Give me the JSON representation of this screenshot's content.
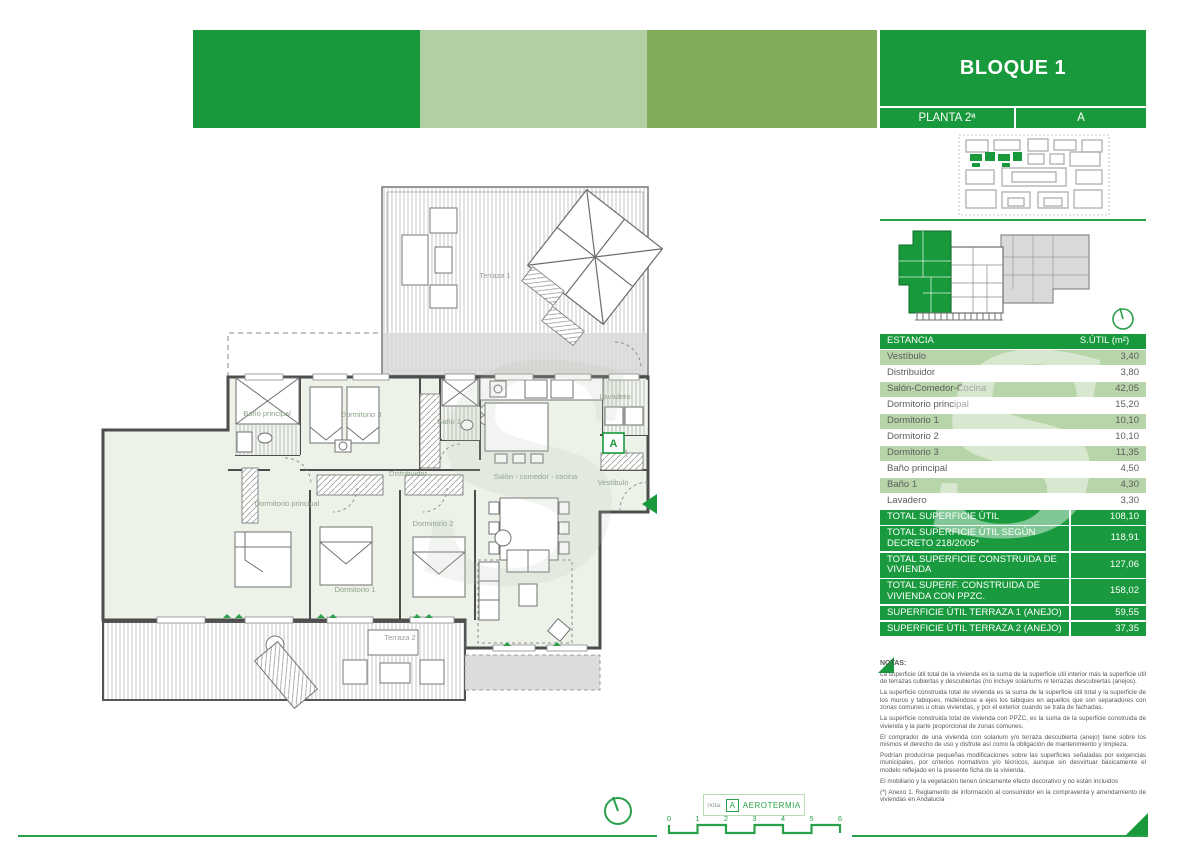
{
  "colors": {
    "brand_green": "#18993b",
    "light_green_block": "#b2cfa4",
    "olive_green_block": "#82ac5b",
    "table_row_green": "#b8d5a9"
  },
  "panel": {
    "title": "BLOQUE 1",
    "floor": "PLANTA 2ª",
    "unit": "A",
    "table": {
      "headers": [
        "ESTANCIA",
        "S.ÚTIL (m²)"
      ],
      "rows": [
        {
          "label": "Vestíbulo",
          "value": "3,40"
        },
        {
          "label": "Distribuidor",
          "value": "3,80"
        },
        {
          "label": "Salón-Comedor-Cocina",
          "value": "42,05"
        },
        {
          "label": "Dormitorio principal",
          "value": "15,20"
        },
        {
          "label": "Dormitorio 1",
          "value": "10,10"
        },
        {
          "label": "Dormitorio 2",
          "value": "10,10"
        },
        {
          "label": "Dormitorio 3",
          "value": "11,35"
        },
        {
          "label": "Baño principal",
          "value": "4,50"
        },
        {
          "label": "Baño 1",
          "value": "4,30"
        },
        {
          "label": "Lavadero",
          "value": "3,30"
        }
      ],
      "totals": [
        {
          "label": "TOTAL SUPERFICIE ÚTIL",
          "value": "108,10"
        },
        {
          "label": "TOTAL SUPERFICIE ÚTIL SEGÚN DECRETO 218/2005*",
          "value": "118,91"
        },
        {
          "label": "TOTAL SUPERFICIE CONSTRUIDA DE VIVIENDA",
          "value": "127,06"
        },
        {
          "label": "TOTAL SUPERF. CONSTRUIDA DE VIVIENDA CON PPZC.",
          "value": "158,02"
        },
        {
          "label": "SUPERFICIE ÚTIL TERRAZA 1 (ANEJO)",
          "value": "59,55"
        },
        {
          "label": "SUPERFICIE ÚTIL TERRAZA 2 (ANEJO)",
          "value": "37,35"
        }
      ]
    },
    "notes": {
      "title": "NOTAS:",
      "paragraphs": [
        "La superficie útil total de la vivienda es la suma de la superficie útil interior más la superficie útil de terrazas cubiertas y descubiertas (no incluye solariums ni terrazas descubiertas (anejos).",
        "La superficie construida total de vivienda es la suma de la superficie útil total y la superficie de los muros y tabiques, midiéndose a ejes los tabiques en aquellos que son separadores con zonas comunes u otras viviendas, y por el exterior cuando se trata de fachadas.",
        "La superficie construida total de vivienda con PPZC, es la suma de la superficie construida de vivienda y la parte proporcional de zonas comunes.",
        "El comprador de una vivienda con solarium y/o terraza descubierta (anejo) tiene sobre los mismos el derecho de uso y disfrute así como la obligación de mantenimiento y limpieza.",
        "Podrían producirse pequeñas modificaciones sobre las superficies señaladas por exigencias municipales, por criterios normativos y/o técnicos, aunque sin desvirtuar básicamente el modelo reflejado en la presente ficha de la vivienda.",
        "El mobiliario y la vegetación tienen únicamente efecto decorativo y no están incluidos",
        "(*) Anexo 1. Reglamento de información al consumidor en la compraventa y arrendamiento de viviendas en Andalucía"
      ]
    }
  },
  "plan": {
    "badge": "A",
    "labels": {
      "terraza1": "Terraza 1",
      "banop": "Baño principal",
      "dorm3": "Dormitorio 3",
      "bano1": "Baño 1",
      "lavadero": "Lavadero",
      "distribuidor": "Distribuidor",
      "salon": "Salón - comedor - cocina",
      "vestibulo": "Vestíbulo",
      "dormp": "Dormitorio principal",
      "dorm1": "Dormitorio 1",
      "dorm2": "Dormitorio 2",
      "terraza2": "Terraza 2"
    }
  },
  "footer": {
    "nota_label": "nota:",
    "nota_badge": "A",
    "nota_text": "AEROTERMIA",
    "scale_ticks": [
      "0",
      "1",
      "2",
      "3",
      "4",
      "5",
      "6"
    ]
  },
  "watermark": {
    "letter": "S"
  }
}
